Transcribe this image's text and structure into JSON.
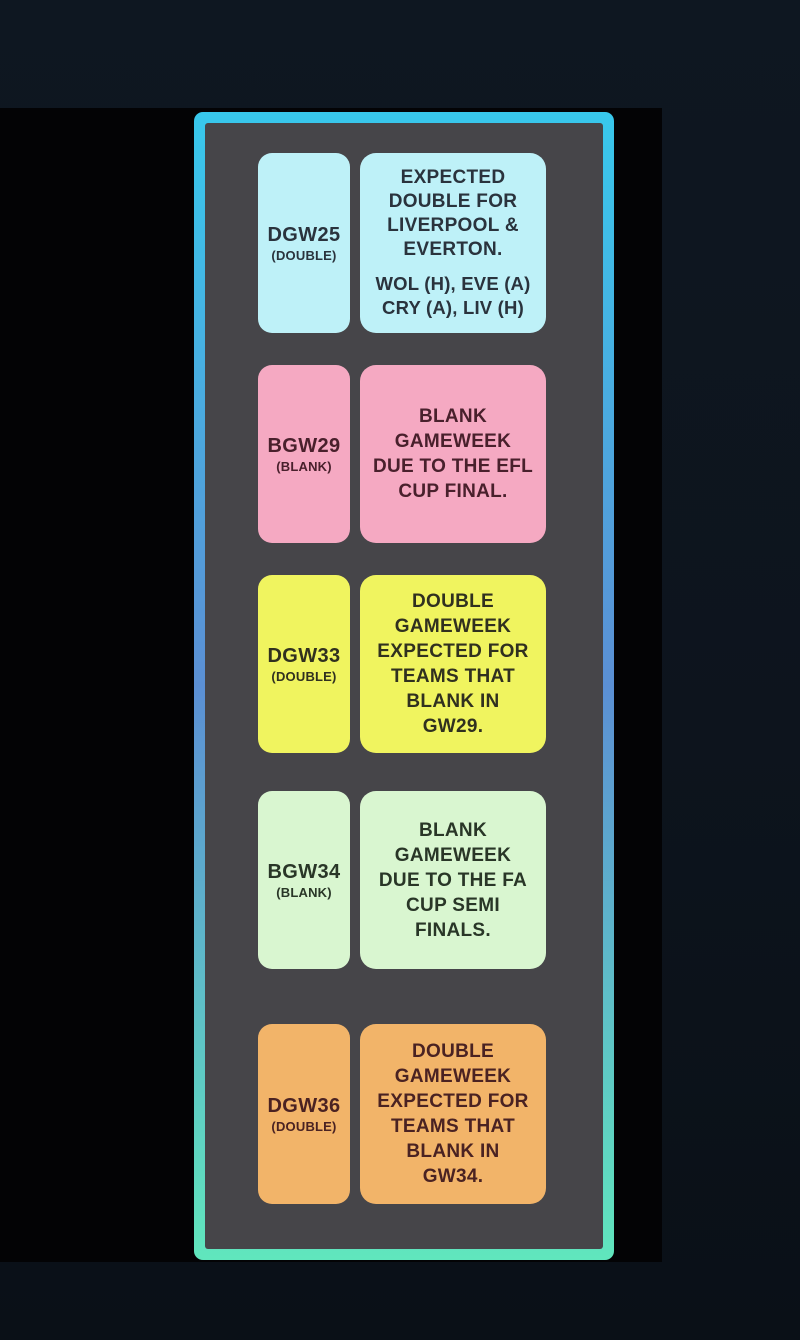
{
  "theme": {
    "page_bg": "#0d141d",
    "backdrop": "#030305",
    "card_inner": "#464549",
    "border_top": "#38c8ec",
    "border_mid": "#5b8fd4",
    "border_bottom": "#60e6bd"
  },
  "rows": [
    {
      "label": "DGW25",
      "sublabel": "(DOUBLE)",
      "description": "EXPECTED\nDOUBLE FOR\nLIVERPOOL &\nEVERTON.",
      "fixtures": "WOL (H), EVE (A)\nCRY (A), LIV (H)",
      "bg": "#bef1f8",
      "fg": "#2a333d"
    },
    {
      "label": "BGW29",
      "sublabel": "(BLANK)",
      "description": "BLANK\nGAMEWEEK\nDUE TO THE EFL\nCUP FINAL.",
      "bg": "#f5a9c2",
      "fg": "#49202c"
    },
    {
      "label": "DGW33",
      "sublabel": "(DOUBLE)",
      "description": "DOUBLE\nGAMEWEEK\nEXPECTED FOR\nTEAMS THAT\nBLANK IN\nGW29.",
      "bg": "#f0f45f",
      "fg": "#30301f"
    },
    {
      "label": "BGW34",
      "sublabel": "(BLANK)",
      "description": "BLANK\nGAMEWEEK\nDUE TO THE FA\nCUP SEMI\nFINALS.",
      "bg": "#d9f6d0",
      "fg": "#293627"
    },
    {
      "label": "DGW36",
      "sublabel": "(DOUBLE)",
      "description": "DOUBLE\nGAMEWEEK\nEXPECTED FOR\nTEAMS THAT\nBLANK IN\nGW34.",
      "bg": "#f2b469",
      "fg": "#4a2222"
    }
  ]
}
